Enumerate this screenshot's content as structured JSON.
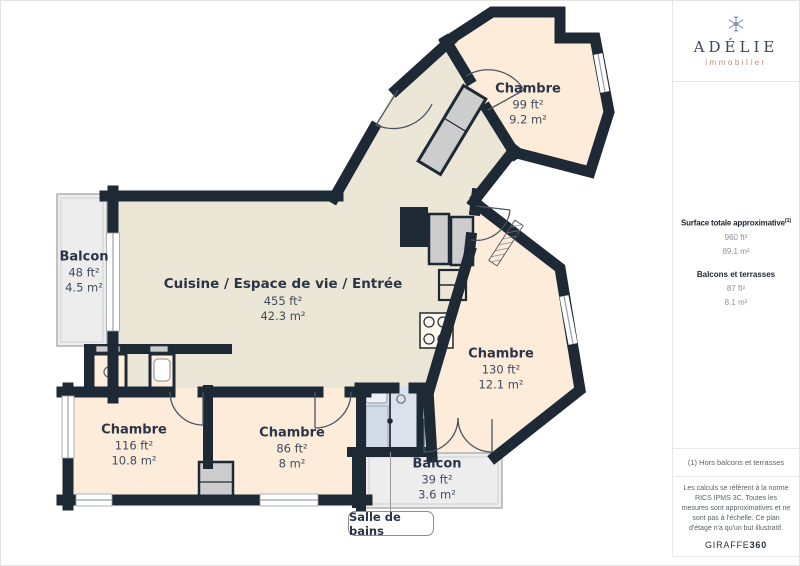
{
  "brand": {
    "name": "ADÉLIE",
    "tagline": "immobilier"
  },
  "sidebar": {
    "surface_title": "Surface totale approximative",
    "surface_footnote_ref": "(1)",
    "surface_ft": "960 ft²",
    "surface_m": "89.1 m²",
    "balconies_title": "Balcons et terrasses",
    "balconies_ft": "87 ft²",
    "balconies_m": "8.1 m²",
    "footnote": "(1) Hors balcons et terrasses",
    "disclaimer": "Les calculs se réfèrent à la norme RICS IPMS 3C. Toutes les mesures sont approximatives et ne sont pas à l'échelle. Ce plan d'étage n'a qu'un but illustratif.",
    "credit_brand": "GIRAFFE",
    "credit_suffix": "360"
  },
  "floorplan": {
    "rooms": [
      {
        "name": "Chambre",
        "area_ft": "99 ft²",
        "area_m": "9.2 m²"
      },
      {
        "name": "Cuisine / Espace de vie / Entrée",
        "area_ft": "455 ft²",
        "area_m": "42.3 m²"
      },
      {
        "name": "Balcon",
        "area_ft": "48 ft²",
        "area_m": "4.5 m²"
      },
      {
        "name": "Chambre",
        "area_ft": "130 ft²",
        "area_m": "12.1 m²"
      },
      {
        "name": "Chambre",
        "area_ft": "116 ft²",
        "area_m": "10.8 m²"
      },
      {
        "name": "Chambre",
        "area_ft": "86 ft²",
        "area_m": "8 m²"
      },
      {
        "name": "Balcon",
        "area_ft": "39 ft²",
        "area_m": "3.6 m²"
      },
      {
        "name": "Salle de bains"
      }
    ],
    "colors": {
      "wall": "#1e2936",
      "living": "#ebe6d5",
      "bedroom": "#fcecd9",
      "balcony": "#ededed",
      "bathroom": "#dce1ec",
      "closet": "#cdcdcd"
    }
  }
}
